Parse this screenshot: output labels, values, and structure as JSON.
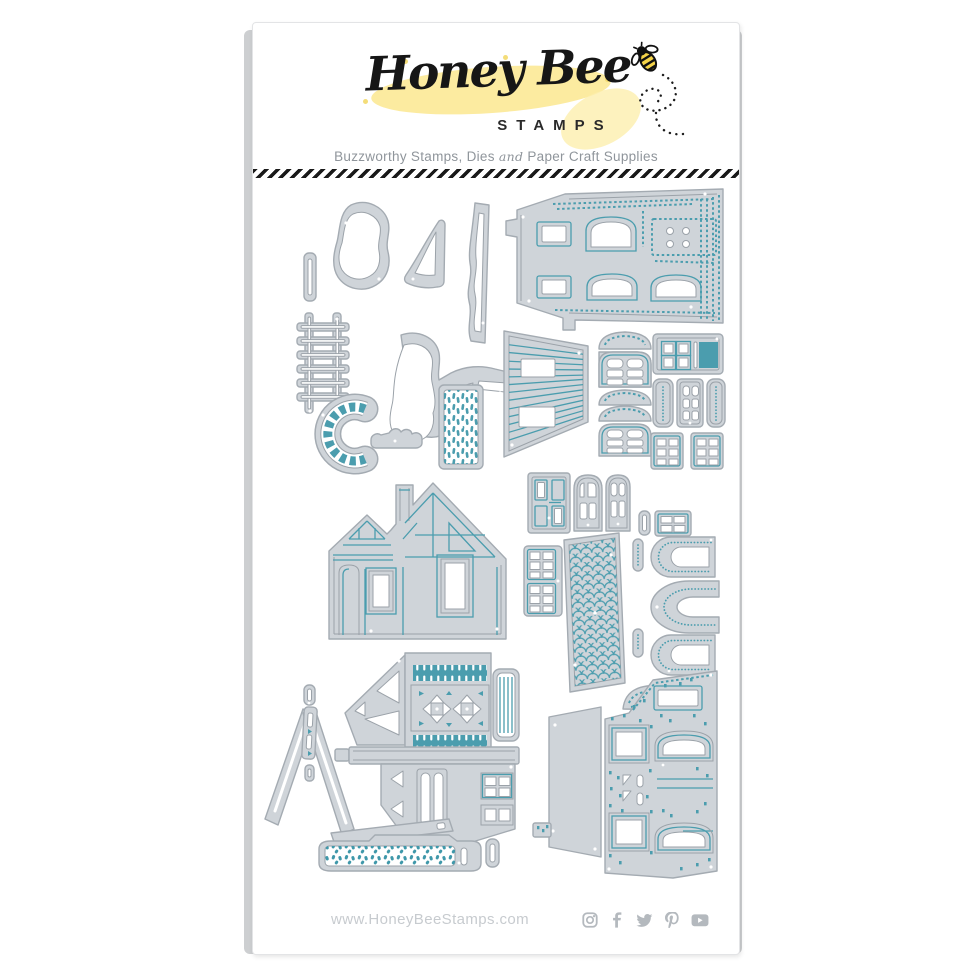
{
  "header": {
    "brand_script": "Honey Bee",
    "brand_word": "STAMPS",
    "tagline_part1": "Buzzworthy Stamps, Dies",
    "tagline_and": "and",
    "tagline_part2": "Paper Craft Supplies"
  },
  "footer": {
    "website": "www.HoneyBeeStamps.com",
    "social": [
      "instagram-icon",
      "facebook-icon",
      "twitter-icon",
      "pinterest-icon",
      "youtube-icon"
    ]
  },
  "colors": {
    "die_fill": "#cfd4d9",
    "die_outline": "#a4abb2",
    "die_inner_cut": "#9ba2a9",
    "teal_accent": "#4b9dae",
    "logo_yellow": "#fbe88f",
    "tagline_gray": "#8f959b",
    "url_gray": "#c7cbcf",
    "icon_gray": "#b4b9be"
  },
  "dies": [
    "twig-stick",
    "bush-large",
    "bush-small",
    "treeline-strip",
    "ladder",
    "tree-canopy-with-branch",
    "stone-path-arch",
    "hedge-small",
    "stone-panel",
    "townhouse-side-wall",
    "clapboard-wall",
    "awning-arch-window-set",
    "kitchen-window",
    "shutter-set",
    "six-pane-window-pair",
    "paneled-door",
    "arched-door-large",
    "arched-door-small",
    "stacked-six-pane-windows",
    "small-pill",
    "four-pane-window",
    "shingle-roof-panel",
    "arched-window-top",
    "arch-frame",
    "arched-window-bottom",
    "curved-awning",
    "cottage-front",
    "roof-gable-trim",
    "victorian-side-wall",
    "tilted-trim-bar",
    "pebble-path-strip",
    "end-pill",
    "porch-side-panel",
    "brick-house-wall"
  ]
}
